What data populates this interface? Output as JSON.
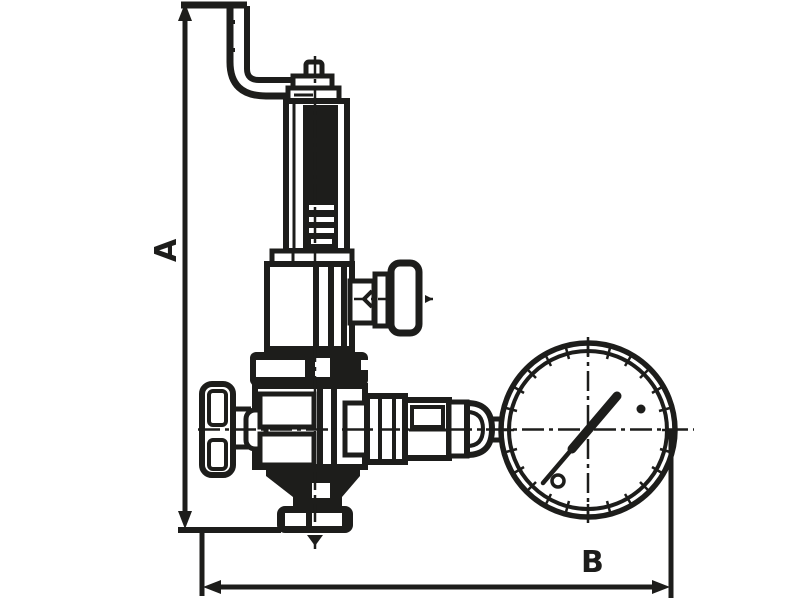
{
  "diagram": {
    "background_color": "#ffffff",
    "line_color": "#1d1d1b",
    "labels": {
      "dim_vertical": "A",
      "dim_horizontal": "B"
    },
    "components": [
      "inlet-pipe",
      "adjusting-screw-cap",
      "spring-housing",
      "bonnet",
      "side-knob",
      "handwheel",
      "valve-body",
      "outlet-flange",
      "gauge-fitting",
      "pressure-gauge",
      "gauge-needle"
    ]
  }
}
